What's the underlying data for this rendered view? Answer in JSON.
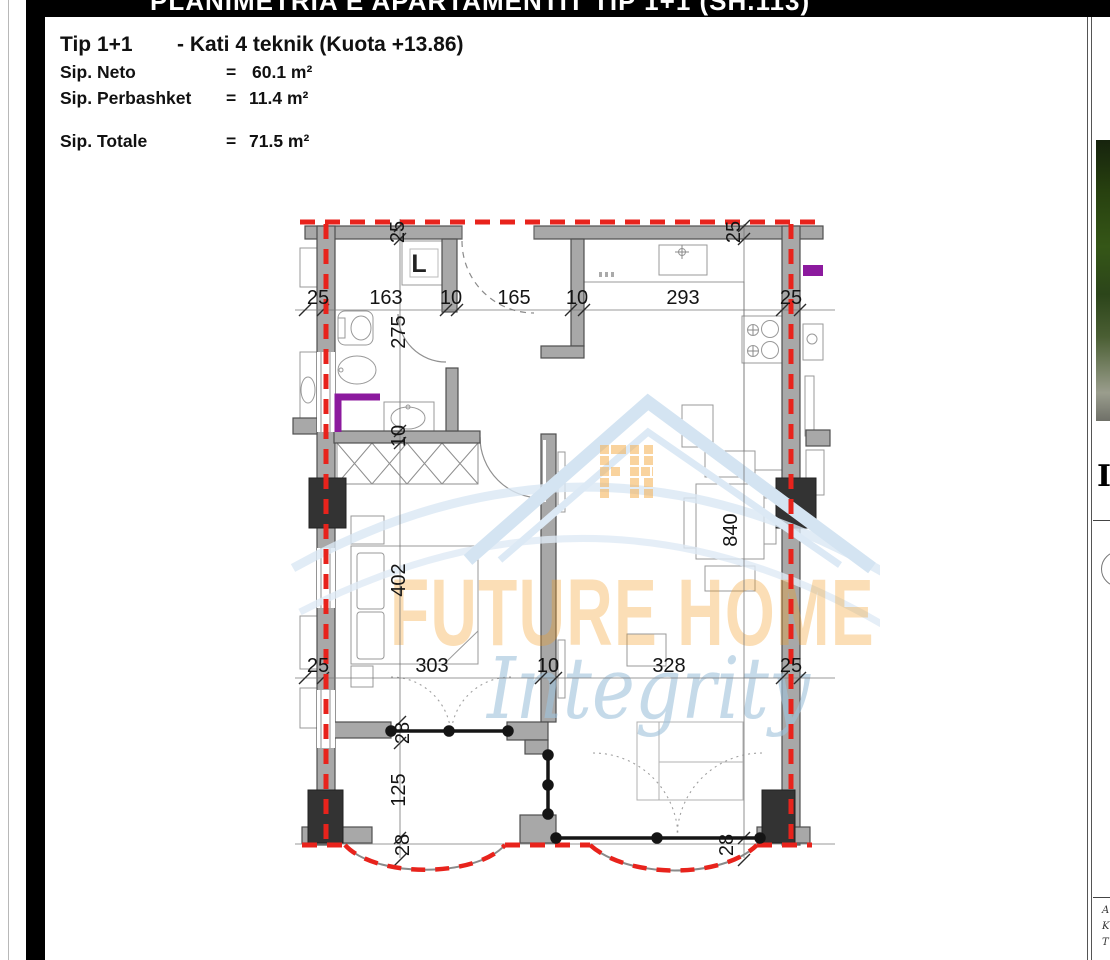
{
  "header_bar": {
    "title": "PLANIMETRIA E APARTAMENTIT TIP 1+1 (SH.113)"
  },
  "title_block": {
    "type_label": "Tip 1+1",
    "subtitle": "- Kati 4 teknik (Kuota +13.86)",
    "rows": [
      {
        "label": "Sip. Neto",
        "eq": "=",
        "value": "60.1 m²"
      },
      {
        "label": "Sip. Perbashket",
        "eq": "=",
        "value": "11.4 m²"
      },
      {
        "label": "Sip. Totale",
        "eq": "=",
        "value": "71.5 m²"
      }
    ]
  },
  "plan": {
    "room_label": "L",
    "dims": {
      "top_row": [
        "25",
        "163",
        "10",
        "165",
        "10",
        "293",
        "25"
      ],
      "top_wall_ticks": [
        "25",
        "25"
      ],
      "left_col": [
        "275",
        "10",
        "402",
        "28",
        "125",
        "28"
      ],
      "mid_row": [
        "25",
        "303",
        "10",
        "328",
        "25"
      ],
      "right_col": [
        "840",
        "28"
      ]
    },
    "colors": {
      "wall": "#a8a8a8",
      "column": "#333333",
      "accent_red": "#e8231c",
      "fixture_purple": "#8c1a9e"
    }
  },
  "watermark": {
    "line1": "FUTURE HOME",
    "line2": "Integrity"
  },
  "side_panel": {
    "letter_fragment": "I",
    "label_fragments": [
      "A",
      "K",
      "T"
    ]
  }
}
